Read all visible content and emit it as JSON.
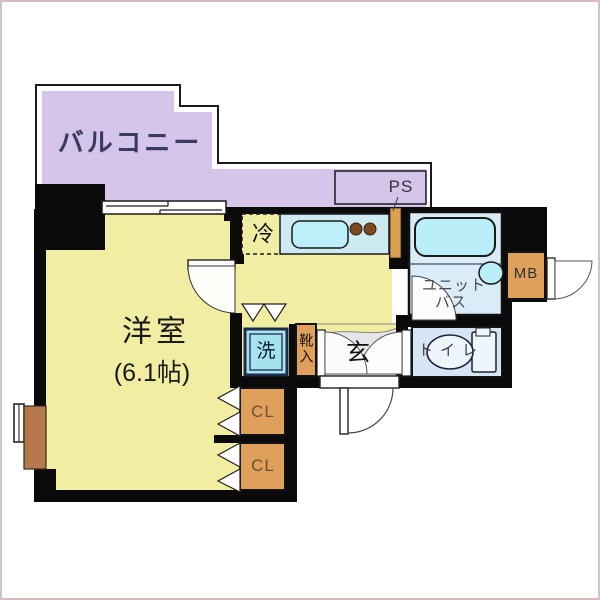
{
  "plan": {
    "type": "apartment-floor-plan",
    "labels": {
      "balcony": "バルコニー",
      "ps": "PS",
      "room_name": "洋室",
      "room_size": "(6.1帖)",
      "fridge": "冷",
      "unit_bath_line1": "ユニット",
      "unit_bath_line2": "バス",
      "meter_box": "MB",
      "toilet": "トイレ",
      "entrance": "玄",
      "washer": "洗",
      "shoe_box": "靴入",
      "closet_1": "CL",
      "closet_2": "CL"
    },
    "colors": {
      "wall": "#0a0a0a",
      "room": "#f1eda3",
      "balcony": "#d5c5ea",
      "orange": "#dfa05c",
      "counter": "#cdeaf3",
      "sink": "#bdeffa",
      "tub": "#baeef8",
      "bath": "#d9ecf7",
      "toilet": "#d6e5f4",
      "fixture": "#eef5fb",
      "washer": "#a5e2ef",
      "washerframe": "#1b2b4b",
      "genkan": "#e6e6ea",
      "brown": "#b5794e",
      "pipe": "#d9a050",
      "burner": "#7c4a20",
      "line": "#1a1a1a",
      "paper": "#ffffff"
    }
  }
}
